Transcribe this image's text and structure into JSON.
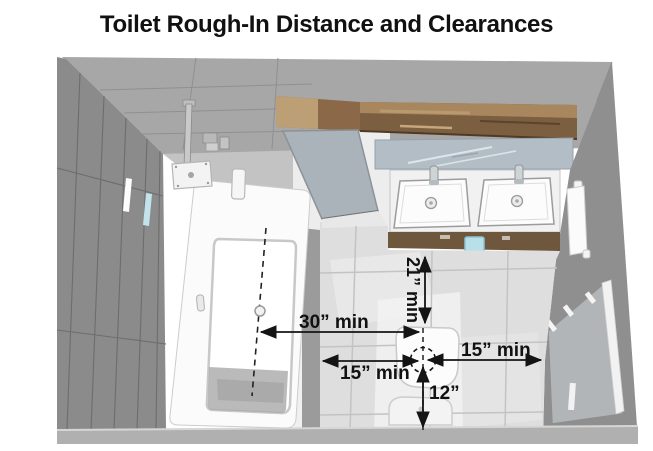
{
  "title": "Toilet Rough-In Distance and Clearances",
  "annotations": {
    "tub_centerline_to_toilet": "30” min",
    "toilet_front_clearance": "21” min",
    "toilet_left_clearance": "15” min",
    "toilet_right_clearance": "15” min",
    "wall_to_flange_rough_in": "12”"
  },
  "colors": {
    "annotation": "#141414",
    "wall_dark": "#8b8b8b",
    "wall_mid": "#a7a7a7",
    "alcove_wall": "#c3c3c3",
    "floor": "#dedede",
    "floor_stripe": "#9b9b9b",
    "wood_shelf": "#7c5e40",
    "wood_cabinet": "#6e573c",
    "mirror": "#b2bdc5",
    "fixture_white": "#fbfbfb",
    "glass_panel": "#b5b9bc",
    "accent_blue": "#b9dfe9",
    "bottom_wall": "#b0b0b0"
  }
}
